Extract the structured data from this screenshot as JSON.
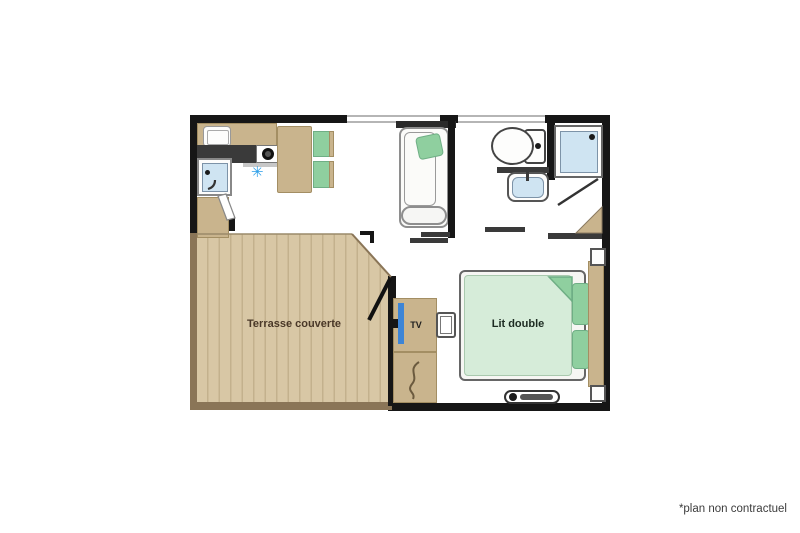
{
  "meta": {
    "footnote": "*plan non contractuel"
  },
  "labels": {
    "terrace": "Terrasse couverte",
    "bed": "Lit double",
    "tv": "TV"
  },
  "icons": {
    "fridge_snowflake": "✳"
  },
  "colors": {
    "wall": "#161616",
    "wood": "#c9b48d",
    "wood-dark": "#8a7557",
    "terrace-a": "#d8c7a5",
    "terrace-b": "#c3b18d",
    "green": "#8fcf9f",
    "green-light": "#d6ecd9",
    "blue-light": "#cfe4f2",
    "blue-tv": "#3d85d6",
    "blue-snow": "#2d9fe8",
    "counter-dark": "#3a3a3a",
    "label-brown": "#4a3828",
    "text": "#3c3c3c"
  }
}
